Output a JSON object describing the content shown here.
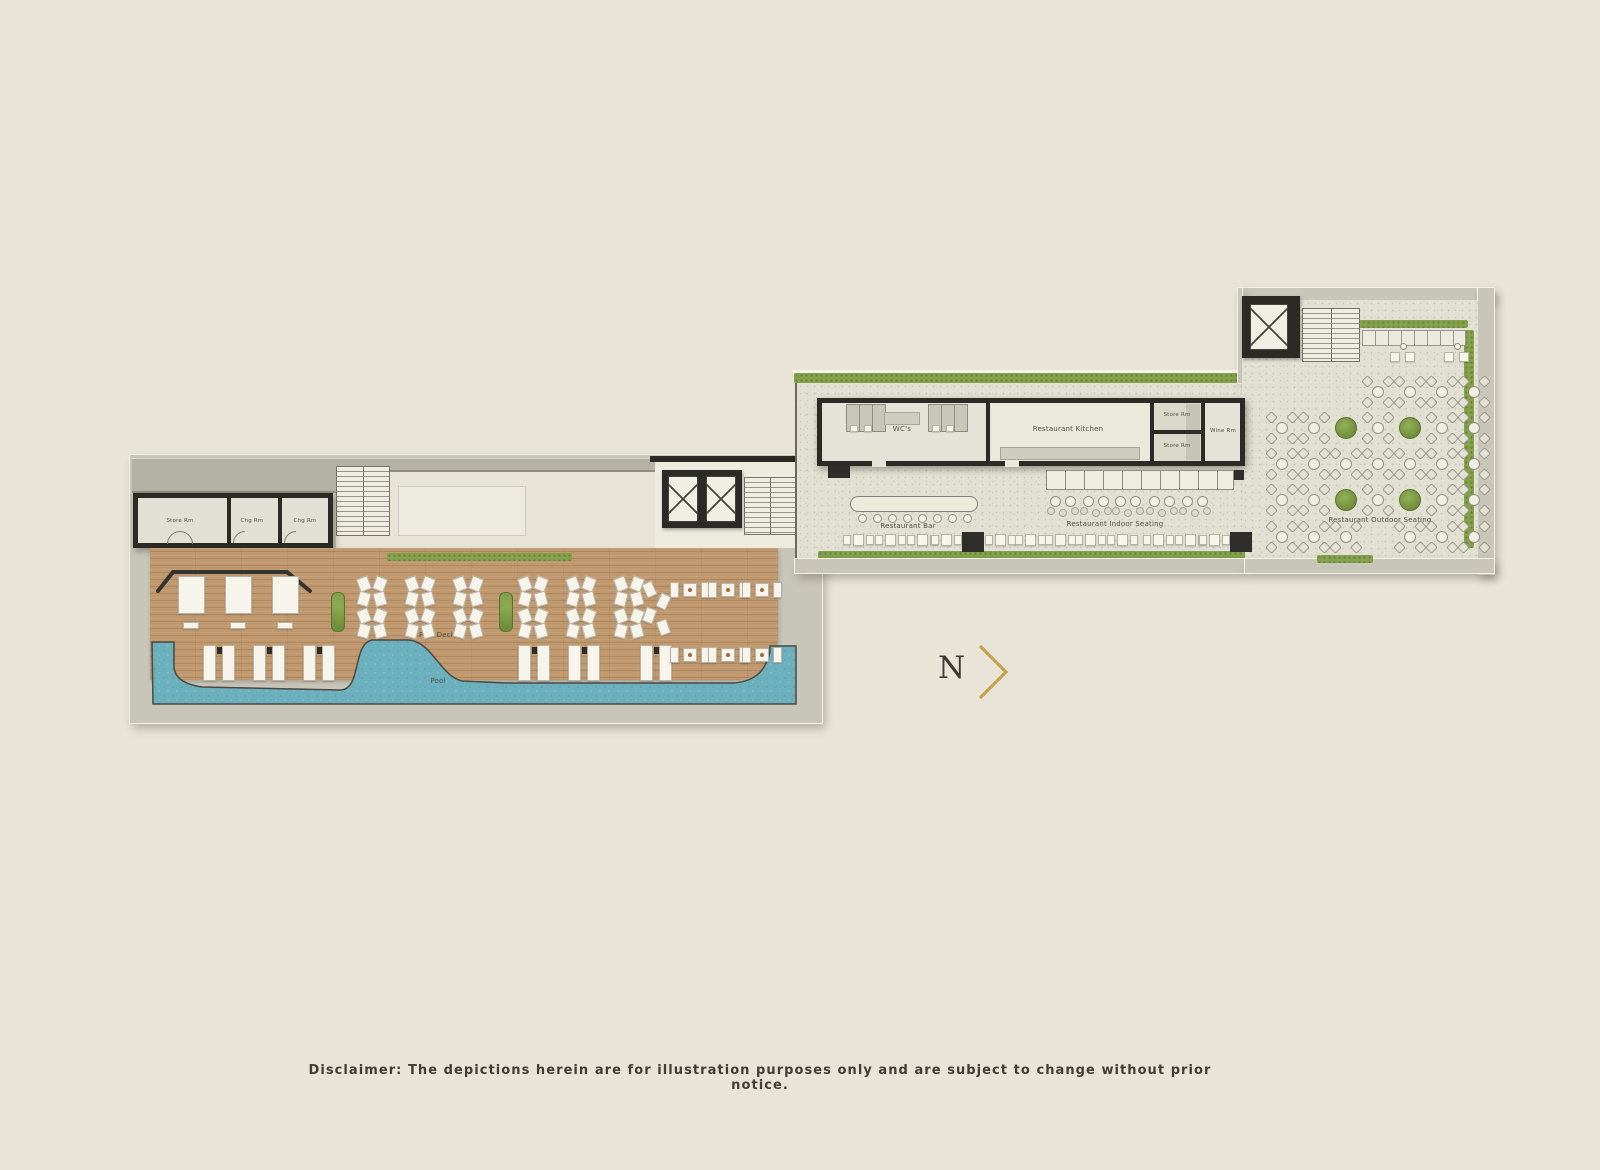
{
  "plan": {
    "left_wing": {
      "rooms": {
        "store": "Store Rm",
        "chg1": "Chg Rm",
        "chg2": "Chg Rm"
      },
      "labels": {
        "pool_deck": "Pool Deck",
        "pool": "Pool"
      }
    },
    "right_wing": {
      "rooms": {
        "wc": "WC's",
        "kitchen": "Restaurant Kitchen",
        "store_a": "Store Rm",
        "store_b": "Store Rm",
        "wine": "Wine Rm"
      },
      "labels": {
        "bar": "Restaurant Bar",
        "indoor": "Restaurant Indoor Seating",
        "outdoor": "Restaurant Outdoor Seating"
      }
    },
    "north": {
      "letter": "N"
    },
    "colors": {
      "background": "#e8e5d8",
      "pool": "#6cb0bd",
      "deck_wood": "#c0986d",
      "landscape_green": "#84a24c",
      "wall": "#2b2a26",
      "north_gold": "#c8a24b"
    }
  },
  "footer": {
    "disclaimer": "Disclaimer: The depictions herein are for illustration purposes only and are subject to change without prior notice."
  }
}
